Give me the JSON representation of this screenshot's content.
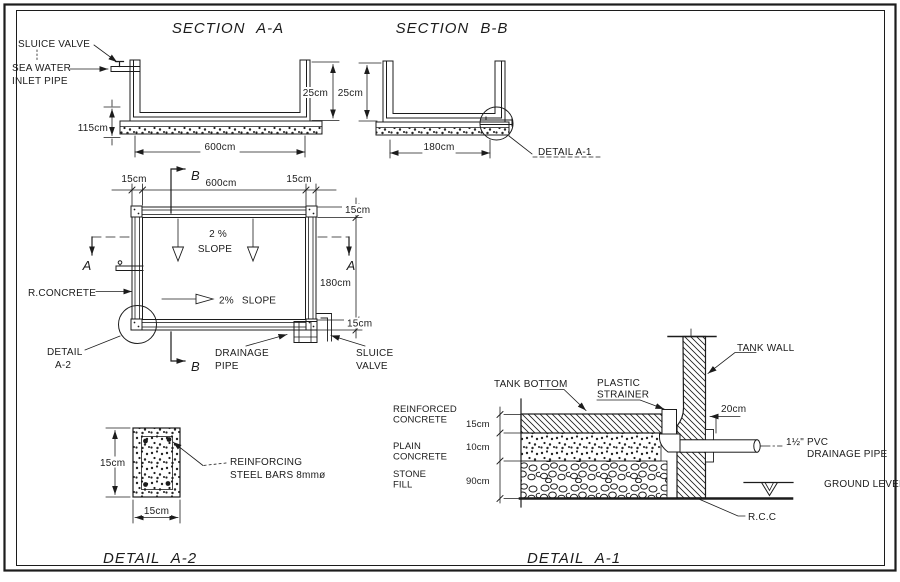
{
  "section_aa": {
    "title": "SECTION A-A",
    "sluice_valve": "SLUICE VALVE",
    "sea_water": "SEA WATER",
    "inlet_pipe": "INLET PIPE",
    "dim_height": "25cm",
    "dim_base": "115cm",
    "dim_width": "600cm"
  },
  "section_bb": {
    "title": "SECTION B-B",
    "dim_height": "25cm",
    "dim_width": "180cm",
    "callout": "DETAIL A-1"
  },
  "plan": {
    "dim_top_left_wall": "15cm",
    "dim_top_width": "600cm",
    "dim_top_right_wall": "15cm",
    "dim_right_top_wall": "15cm",
    "dim_right_height": "180cm",
    "dim_right_bottom_wall": "15cm",
    "marker_a": "A",
    "marker_b": "B",
    "slope_pct": "2 %",
    "slope_word": "SLOPE",
    "slope_horiz": "2% SLOPE",
    "r_concrete": "R.CONCRETE",
    "detail_word": "DETAIL",
    "detail_ref": "A-2",
    "drainage": "DRAINAGE",
    "pipe": "PIPE",
    "sluice": "SLUICE",
    "valve": "VALVE"
  },
  "detail_a2": {
    "title": "DETAIL A-2",
    "dim_height": "15cm",
    "dim_width": "15cm",
    "label_line1": "REINFORCING",
    "label_line2": "STEEL BARS 8mmø"
  },
  "detail_a1": {
    "title": "DETAIL A-1",
    "tank_wall": "TANK WALL",
    "tank_bottom": "TANK BOTTOM",
    "plastic": "PLASTIC",
    "strainer": "STRAINER",
    "reinforced_l1": "REINFORCED",
    "reinforced_l2": "CONCRETE",
    "plain_l1": "PLAIN",
    "plain_l2": "CONCRETE",
    "stone_l1": "STONE",
    "stone_l2": "FILL",
    "dim_rc": "15cm",
    "dim_plain": "10cm",
    "dim_stone": "90cm",
    "dim_wall": "20cm",
    "pvc_l1": "1½\" PVC",
    "pvc_l2": "DRAINAGE PIPE",
    "ground": "GROUND LEVEL",
    "rcc": "R.C.C"
  },
  "colors": {
    "ink": "#1c1c1c",
    "paper": "#ffffff"
  }
}
